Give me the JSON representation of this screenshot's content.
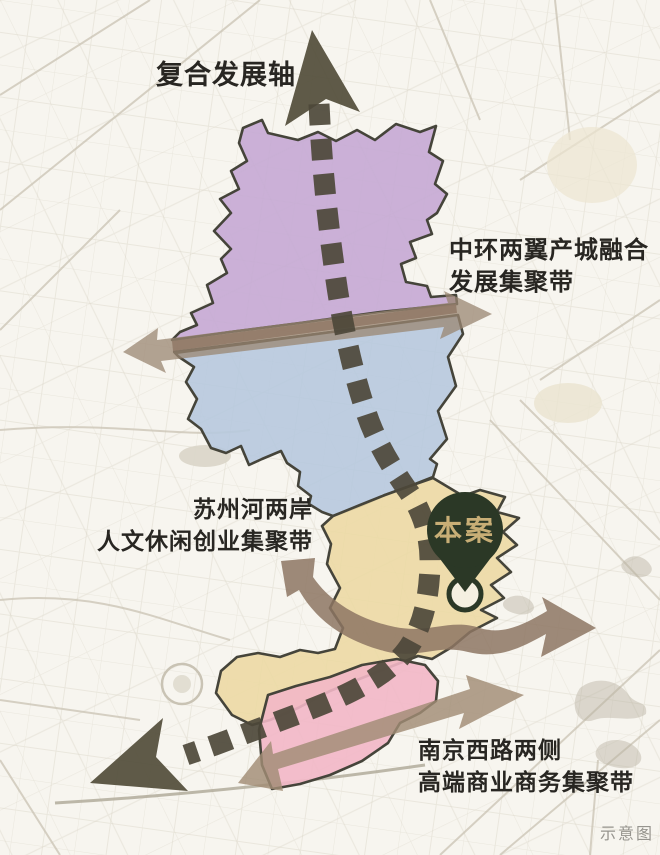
{
  "map": {
    "watermark": "示意图",
    "site_marker": "本案",
    "labels": {
      "composite_axis": "复合发展轴",
      "midring_line1": "中环两翼产城融合",
      "midring_line2": "发展集聚带",
      "suzhou_line1": "苏州河两岸",
      "suzhou_line2": "人文休闲创业集聚带",
      "nanjing_line1": "南京西路两侧",
      "nanjing_line2": "高端商业商务集聚带"
    },
    "colors": {
      "zone_purple": "#c5a8d4",
      "zone_blue": "#b7c9de",
      "zone_yellow": "#ecd9a4",
      "zone_pink": "#f2b7c6",
      "divider_maroon": "#7d5a4e",
      "axis_dark": "#56513e",
      "dash": "#4d4839",
      "band_midring": "#9a8571",
      "band_suzhou": "#8d7663",
      "band_nanjing": "#a18c75",
      "pin_green": "#2b3826",
      "pin_text": "#c8ae76",
      "label_text": "#282622",
      "watermark_text": "#96948e"
    }
  }
}
